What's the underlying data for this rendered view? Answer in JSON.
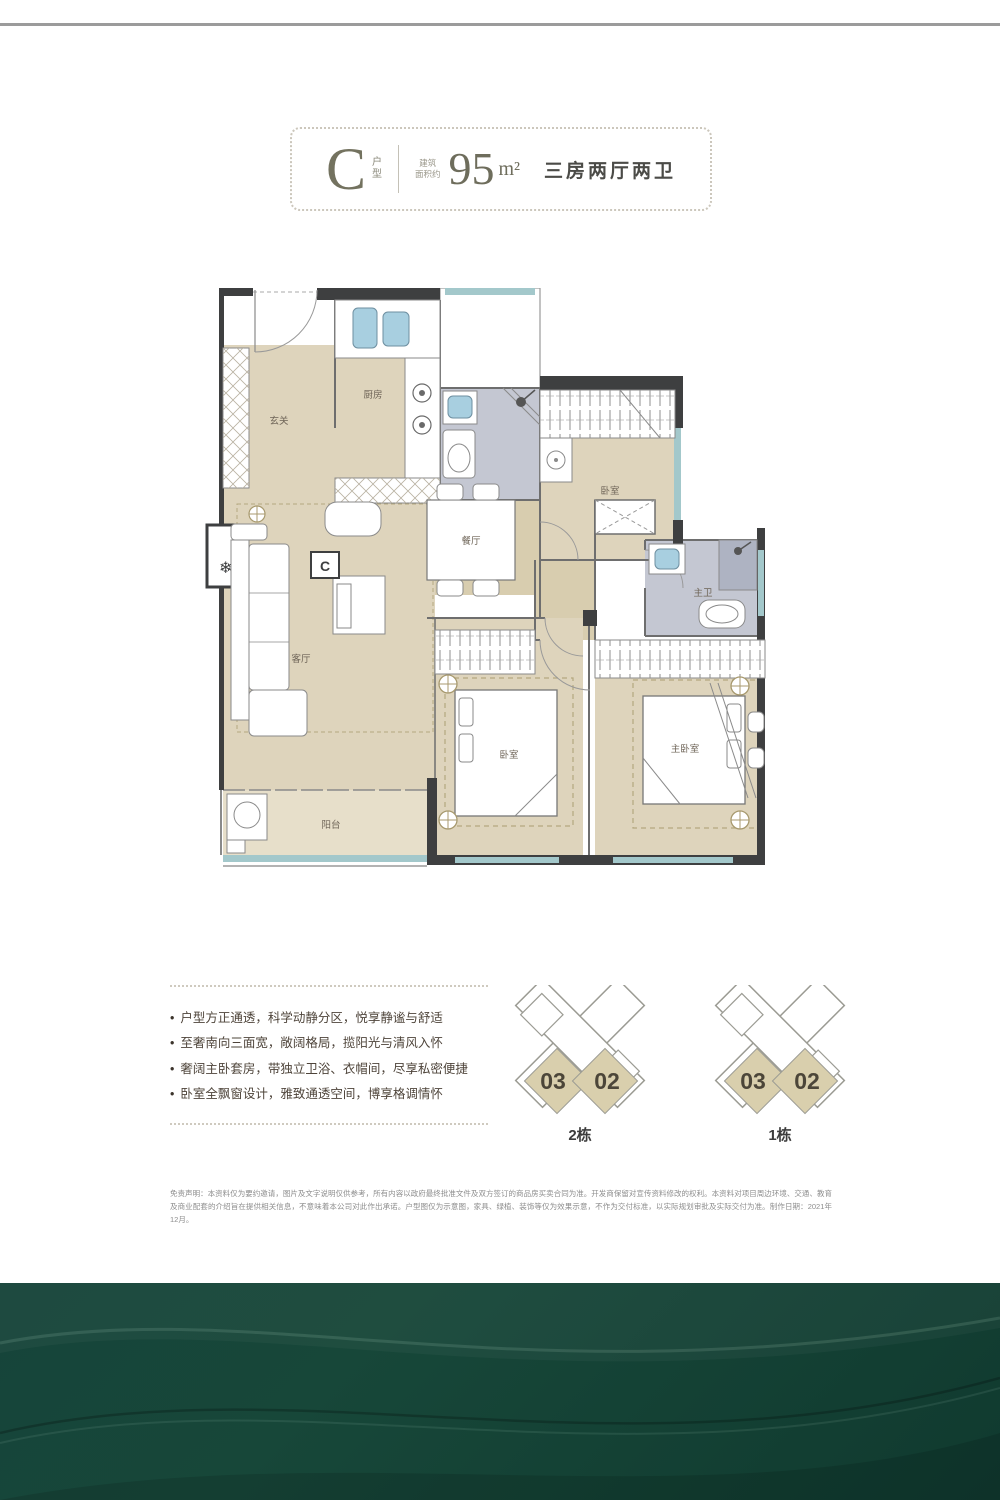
{
  "header": {
    "unit_letter": "C",
    "unit_label": "户型",
    "area_label_lines": [
      "建筑",
      "面积约"
    ],
    "area_value": "95",
    "area_unit": "m²",
    "layout_text": "三房两厅两卫"
  },
  "floor_plan": {
    "marker": "C",
    "rooms": [
      {
        "id": "foyer",
        "label": "玄关"
      },
      {
        "id": "kitchen",
        "label": "厨房"
      },
      {
        "id": "dining",
        "label": "餐厅"
      },
      {
        "id": "living",
        "label": "客厅"
      },
      {
        "id": "balcony",
        "label": "阳台"
      },
      {
        "id": "bedroom-north",
        "label": "卧室"
      },
      {
        "id": "master-bath",
        "label": "主卫"
      },
      {
        "id": "bedroom-south",
        "label": "卧室"
      },
      {
        "id": "master-bedroom",
        "label": "主卧室"
      }
    ]
  },
  "features": {
    "items": [
      "户型方正通透，科学动静分区，悦享静谧与舒适",
      "至奢南向三面宽，敞阔格局，揽阳光与清风入怀",
      "奢阔主卧套房，带独立卫浴、衣帽间，尽享私密便捷",
      "卧室全飘窗设计，雅致通透空间，博享格调情怀"
    ]
  },
  "site_plans": [
    {
      "building": "2栋",
      "unit_left": "03",
      "unit_right": "02"
    },
    {
      "building": "1栋",
      "unit_left": "03",
      "unit_right": "02"
    }
  ],
  "disclaimer": "免责声明：本资料仅为要约邀请，图片及文字说明仅供参考，所有内容以政府最终批准文件及双方签订的商品房买卖合同为准。开发商保留对宣传资料修改的权利。本资料对项目周边环境、交通、教育及商业配套的介绍旨在提供相关信息，不意味着本公司对此作出承诺。户型图仅为示意图，家具、绿植、装饰等仅为效果示意，不作为交付标准，以实际规划审批及实际交付为准。制作日期：2021年12月。",
  "colors": {
    "footer_green": "#16443a",
    "floor_beige": "#ded4bc",
    "bath_grey": "#c4c7d2",
    "fixture_blue": "#a8cfe0",
    "window_teal": "#a3c8cb",
    "unit_highlight": "#d9cfad"
  }
}
